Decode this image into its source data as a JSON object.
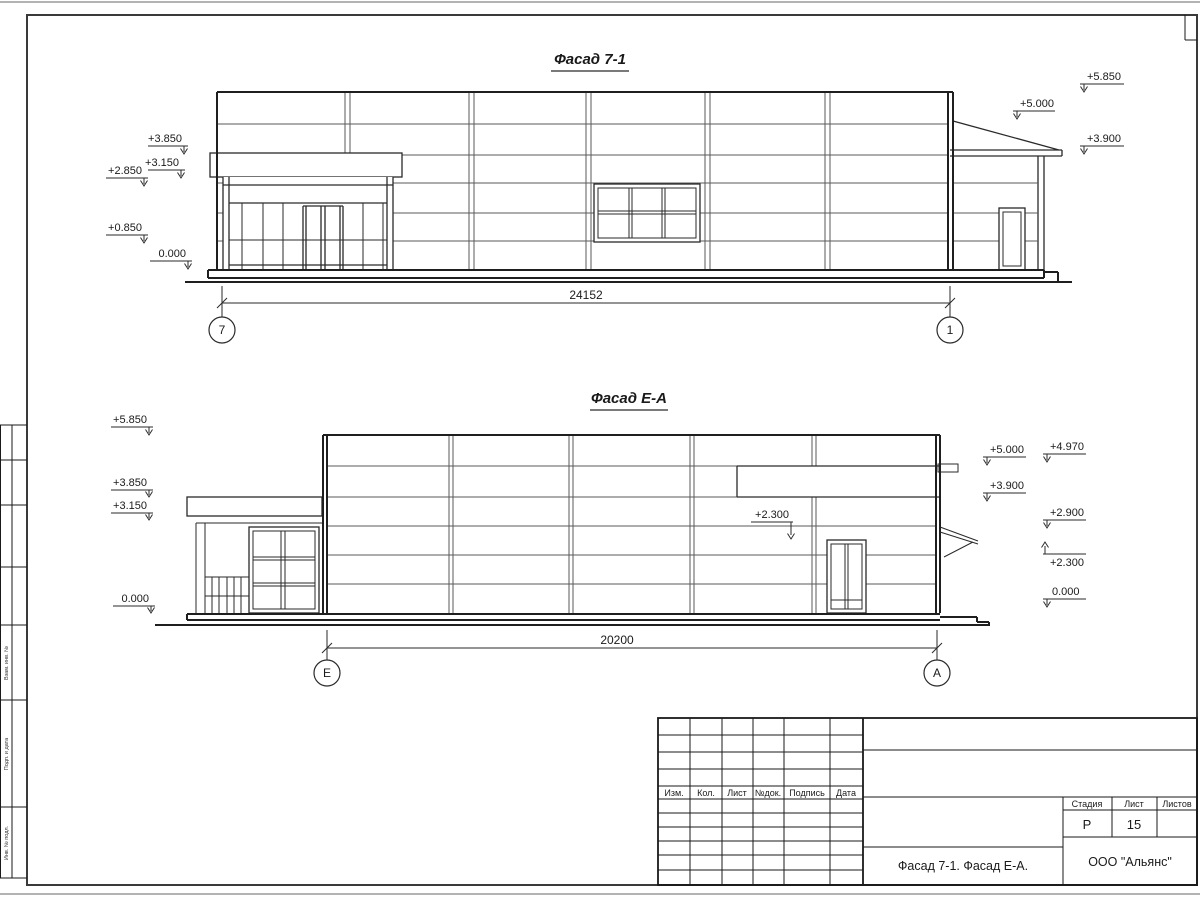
{
  "frame": {
    "strip_labels": [
      "Взам. инв. №",
      "Подп. и дата",
      "Инв. № подл."
    ]
  },
  "facade1": {
    "title": "Фасад 7-1",
    "marks_left": [
      "+3.850",
      "+3.150",
      "+2.850",
      "+0.850",
      "0.000"
    ],
    "marks_right": [
      "+5.850",
      "+5.000",
      "+3.900"
    ],
    "dimension": "24152",
    "axis_left": "7",
    "axis_right": "1"
  },
  "facade2": {
    "title": "Фасад Е-А",
    "marks_left": [
      "+5.850",
      "+3.850",
      "+3.150",
      "0.000"
    ],
    "mark_middle": "+2.300",
    "marks_right": [
      "+5.000",
      "+4.970",
      "+3.900",
      "+2.900",
      "+2.300",
      "0.000"
    ],
    "dimension": "20200",
    "axis_left": "Е",
    "axis_right": "А"
  },
  "titleblock": {
    "revision_headers": [
      "Изм.",
      "Кол.",
      "Лист",
      "№док.",
      "Подпись",
      "Дата"
    ],
    "stage_label": "Стадия",
    "sheet_label": "Лист",
    "sheets_label": "Листов",
    "stage_value": "Р",
    "sheet_value": "15",
    "doc_title": "Фасад 7-1. Фасад Е-А.",
    "company": "ООО \"Альянс\""
  }
}
